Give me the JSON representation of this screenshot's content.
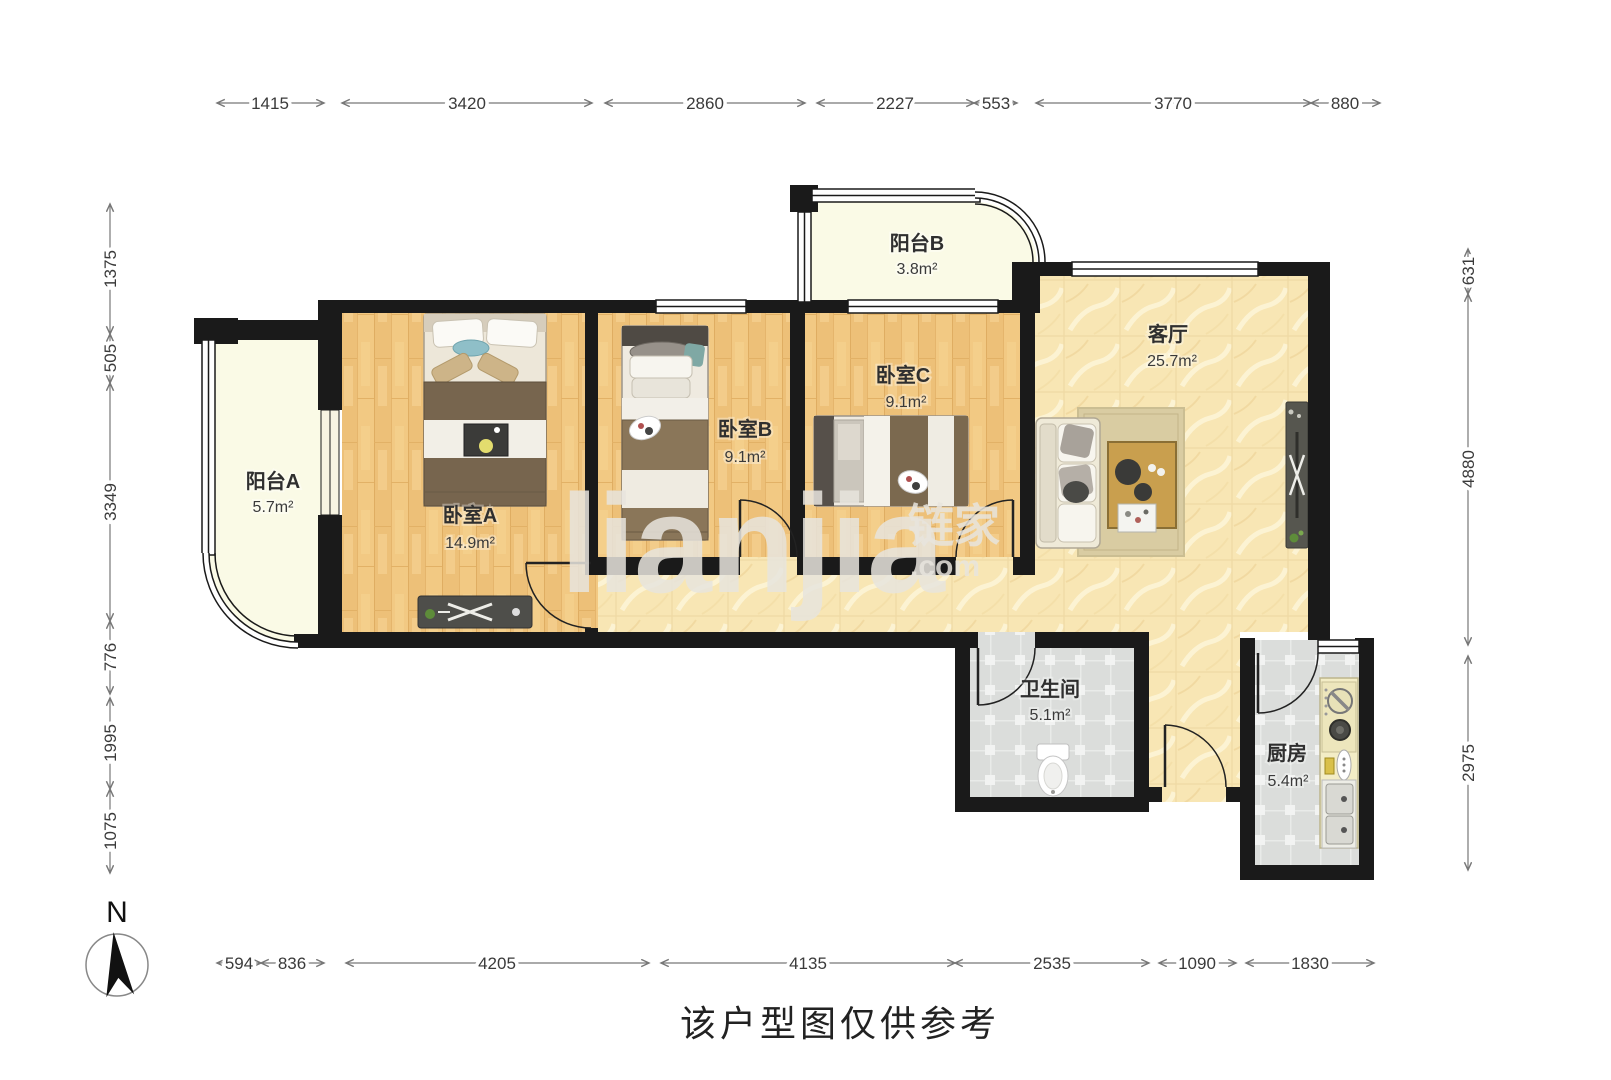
{
  "meta": {
    "caption": "该户型图仅供参考",
    "north": "N"
  },
  "watermark": {
    "latin": "lianjia",
    "cn": "链家",
    "com": ".com"
  },
  "rooms": {
    "balcony_a": {
      "name": "阳台A",
      "area": "5.7m²"
    },
    "bedroom_a": {
      "name": "卧室A",
      "area": "14.9m²"
    },
    "bedroom_b": {
      "name": "卧室B",
      "area": "9.1m²"
    },
    "bedroom_c": {
      "name": "卧室C",
      "area": "9.1m²"
    },
    "balcony_b": {
      "name": "阳台B",
      "area": "3.8m²"
    },
    "living_room": {
      "name": "客厅",
      "area": "25.7m²"
    },
    "bathroom": {
      "name": "卫生间",
      "area": "5.1m²"
    },
    "kitchen": {
      "name": "厨房",
      "area": "5.4m²"
    }
  },
  "dims": {
    "top": [
      "1415",
      "3420",
      "2860",
      "2227",
      "553",
      "3770",
      "880"
    ],
    "left": [
      "1375",
      "505",
      "3349",
      "776",
      "1995",
      "1075"
    ],
    "right": [
      "631",
      "4880",
      "2975"
    ],
    "bottom": [
      "594",
      "836",
      "4205",
      "4135",
      "2535",
      "1090",
      "1830"
    ]
  },
  "colors": {
    "wall": "#1a1a1a",
    "wood": "#f2c983",
    "marble": "#f8e6b4",
    "tile": "#dbdddb",
    "balcony": "#fafae6",
    "dim_line": "#777777",
    "dim_text": "#3a3a3a"
  }
}
